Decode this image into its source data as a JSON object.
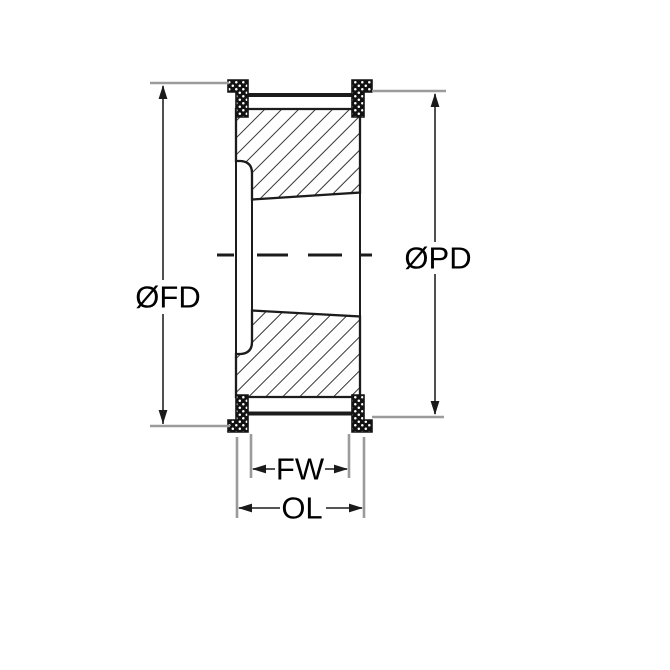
{
  "diagram": {
    "title": "timing-pulley-cross-section",
    "labels": {
      "flange_diameter": "ØFD",
      "pitch_diameter": "ØPD",
      "face_width": "FW",
      "overall_length": "OL"
    },
    "colors": {
      "part_line": "#1c1c1c",
      "extension_line": "#9b9b9b",
      "dimension_line": "#3d3d3d",
      "label_text": "#000000",
      "background": "#ffffff"
    }
  }
}
